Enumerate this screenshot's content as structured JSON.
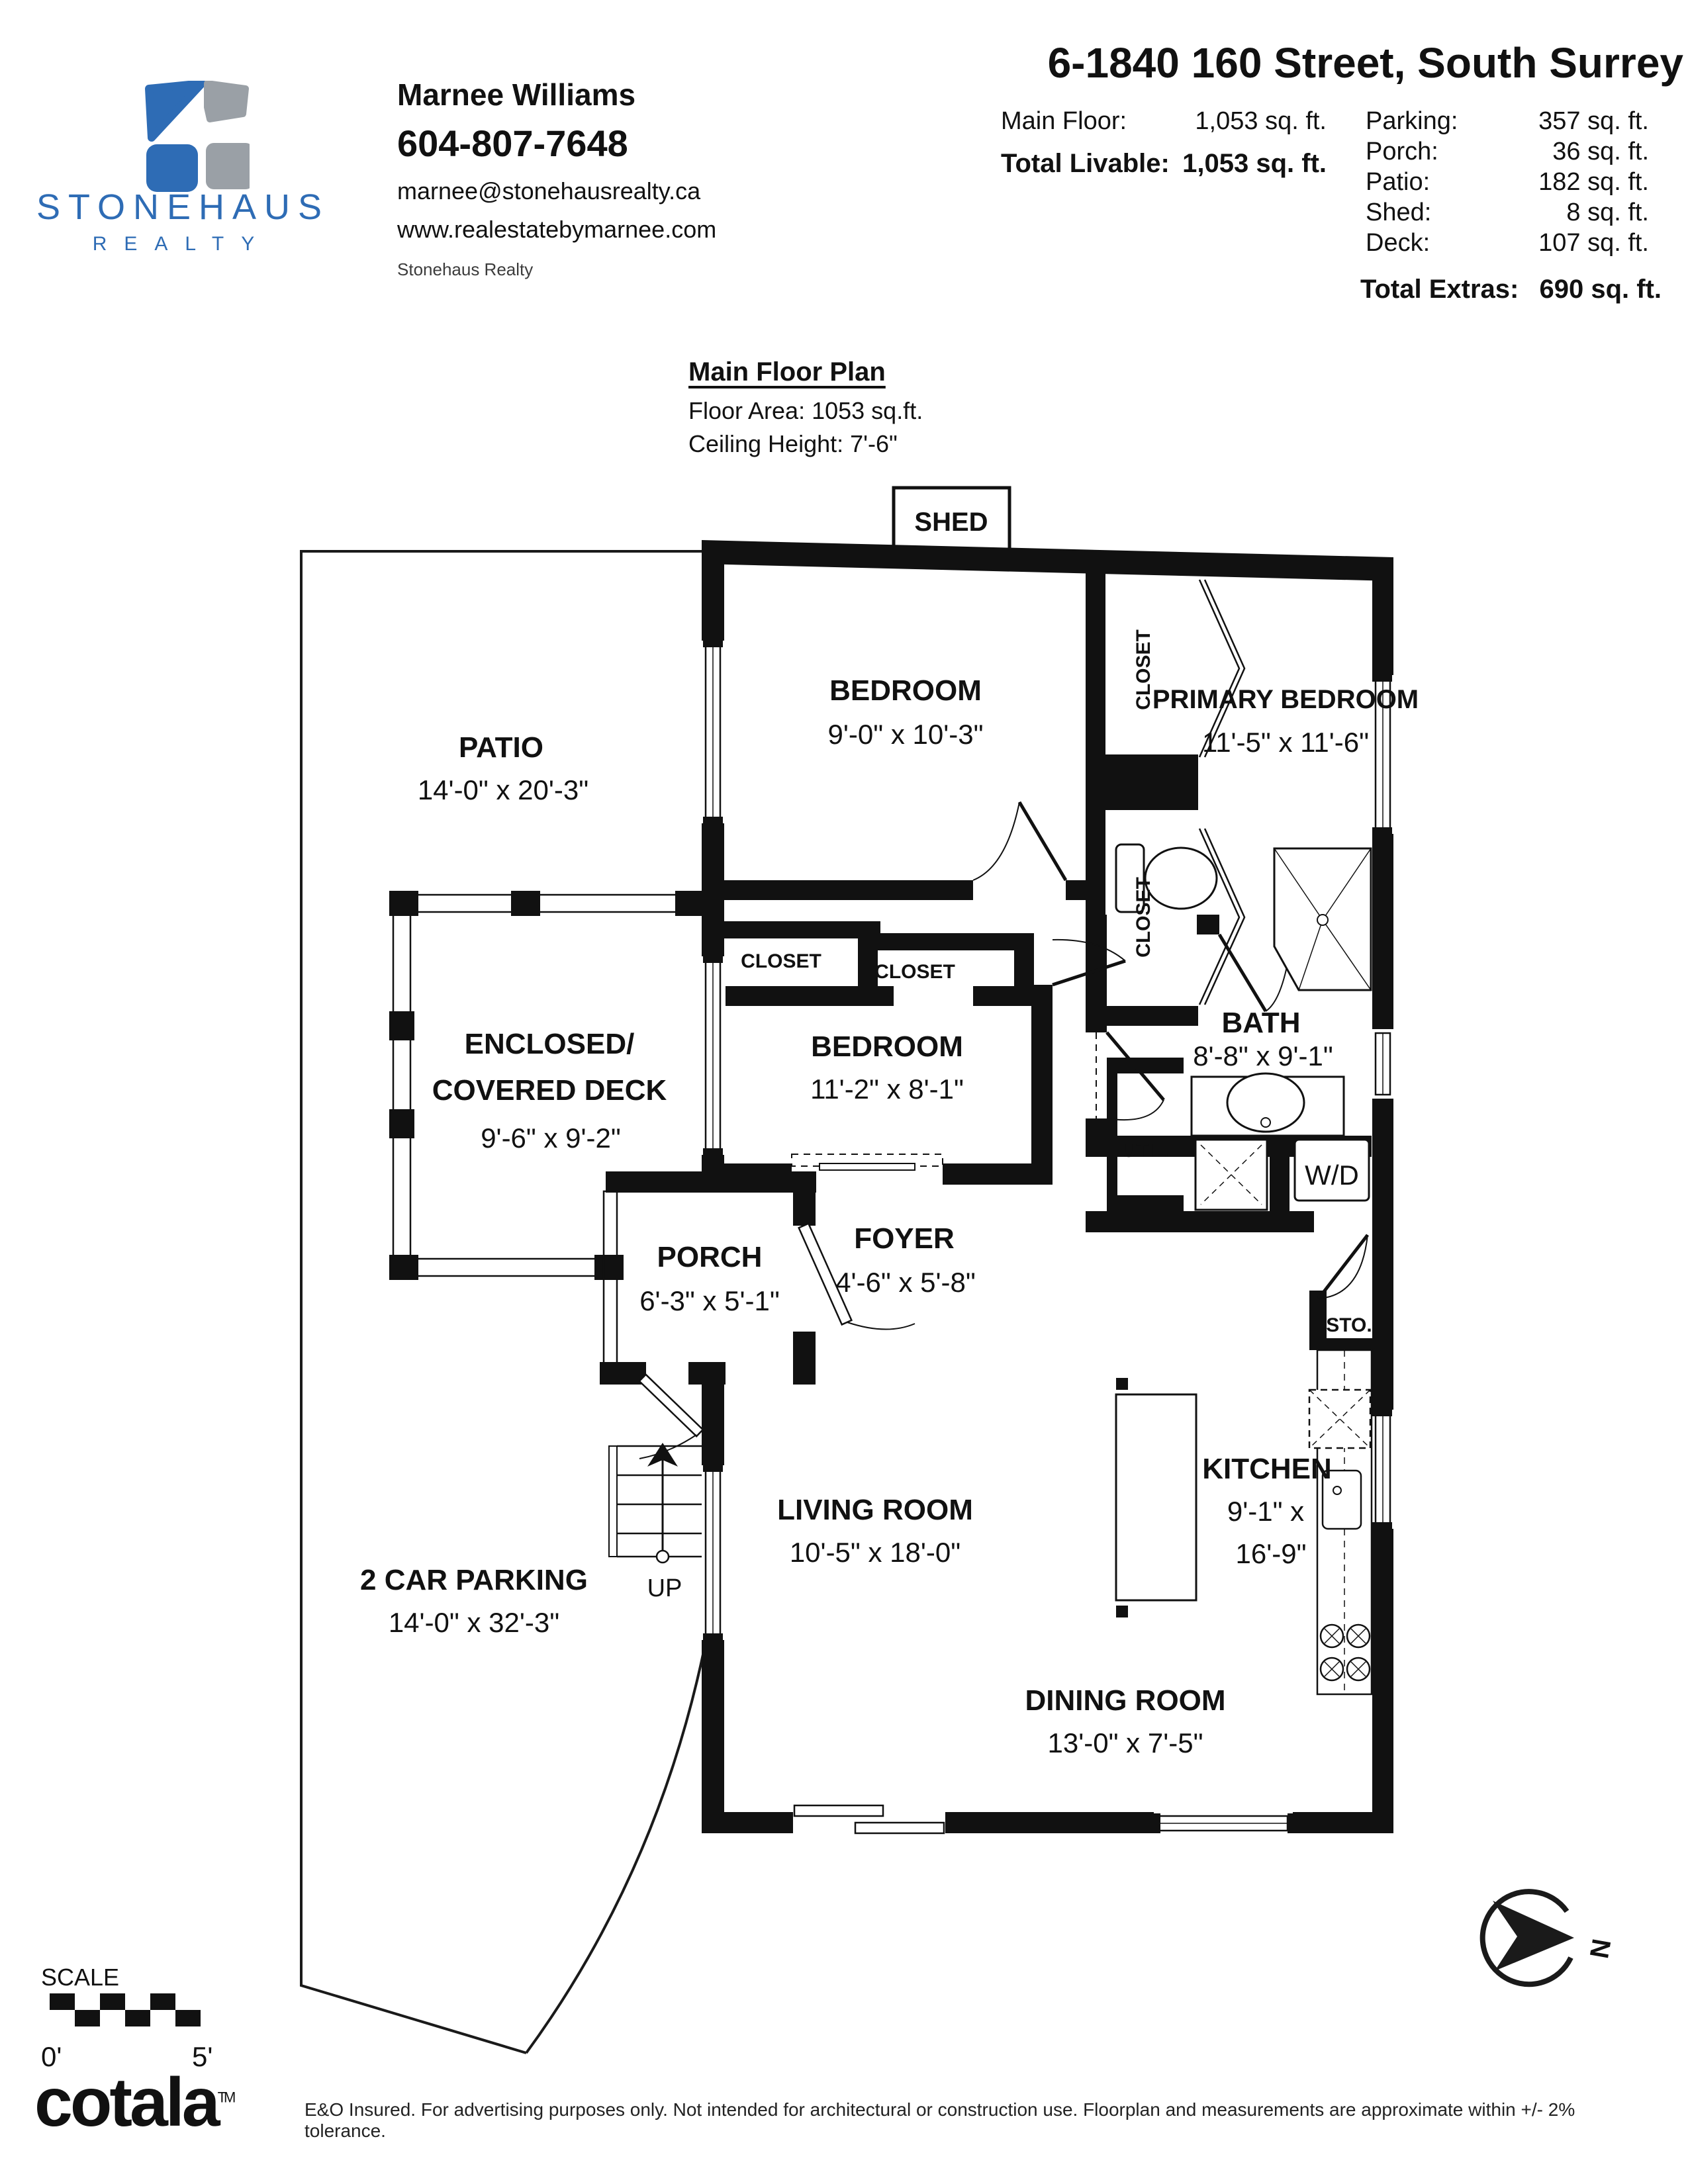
{
  "header": {
    "brand": {
      "name": "STONEHAUS",
      "subname": "REALTY",
      "colors": {
        "blue": "#2e6cb5",
        "gray": "#9aa0a6"
      }
    },
    "agent": {
      "name": "Marnee Williams",
      "phone": "604-807-7648",
      "email": "marnee@stonehausrealty.ca",
      "website": "www.realestatebymarnee.com",
      "brokerage": "Stonehaus Realty"
    },
    "listing_title": "6-1840 160 Street, South Surrey",
    "areas": {
      "main_floor_label": "Main Floor:",
      "main_floor_value": "1,053 sq. ft.",
      "total_livable_label": "Total Livable:",
      "total_livable_value": "1,053 sq. ft.",
      "extras": [
        {
          "label": "Parking:",
          "value": "357 sq. ft."
        },
        {
          "label": "Porch:",
          "value": "36 sq. ft."
        },
        {
          "label": "Patio:",
          "value": "182 sq. ft."
        },
        {
          "label": "Shed:",
          "value": "8 sq. ft."
        },
        {
          "label": "Deck:",
          "value": "107 sq. ft."
        }
      ],
      "total_extras_label": "Total Extras:",
      "total_extras_value": "690 sq. ft."
    }
  },
  "plan": {
    "title": "Main Floor Plan",
    "floor_area": "Floor Area: 1053 sq.ft.",
    "ceiling_height": "Ceiling Height: 7'-6\"",
    "rooms": {
      "shed": {
        "name": "SHED"
      },
      "patio": {
        "name": "PATIO",
        "dims": "14'-0\" x 20'-3\""
      },
      "bedroom1": {
        "name": "BEDROOM",
        "dims": "9'-0\" x 10'-3\""
      },
      "primary": {
        "name": "PRIMARY BEDROOM",
        "dims": "11'-5\" x 11'-6\""
      },
      "deck": {
        "name_line1": "ENCLOSED/",
        "name_line2": "COVERED DECK",
        "dims": "9'-6\" x 9'-2\""
      },
      "bedroom2": {
        "name": "BEDROOM",
        "dims": "11'-2\" x 8'-1\""
      },
      "bath": {
        "name": "BATH",
        "dims": "8'-8\" x 9'-1\""
      },
      "porch": {
        "name": "PORCH",
        "dims": "6'-3\" x 5'-1\""
      },
      "foyer": {
        "name": "FOYER",
        "dims": "4'-6\" x 5'-8\""
      },
      "parking": {
        "name": "2 CAR PARKING",
        "dims": "14'-0\" x 32'-3\""
      },
      "living": {
        "name": "LIVING ROOM",
        "dims": "10'-5\" x 18'-0\""
      },
      "kitchen": {
        "name": "KITCHEN",
        "dims_line1": "9'-1\" x",
        "dims_line2": "16'-9\""
      },
      "dining": {
        "name": "DINING ROOM",
        "dims": "13'-0\" x 7'-5\""
      }
    },
    "labels": {
      "closet": "CLOSET",
      "util": "UTIL.",
      "wd": "W/D",
      "sto": "STO.",
      "up": "UP"
    }
  },
  "footer": {
    "scale_label": "SCALE",
    "scale_start": "0'",
    "scale_end": "5'",
    "logo": "cotala",
    "logo_tm": "TM",
    "north_label": "N",
    "disclaimer": "E&O Insured. For advertising purposes only. Not intended for architectural or construction use. Floorplan and measurements are approximate within +/- 2% tolerance."
  }
}
